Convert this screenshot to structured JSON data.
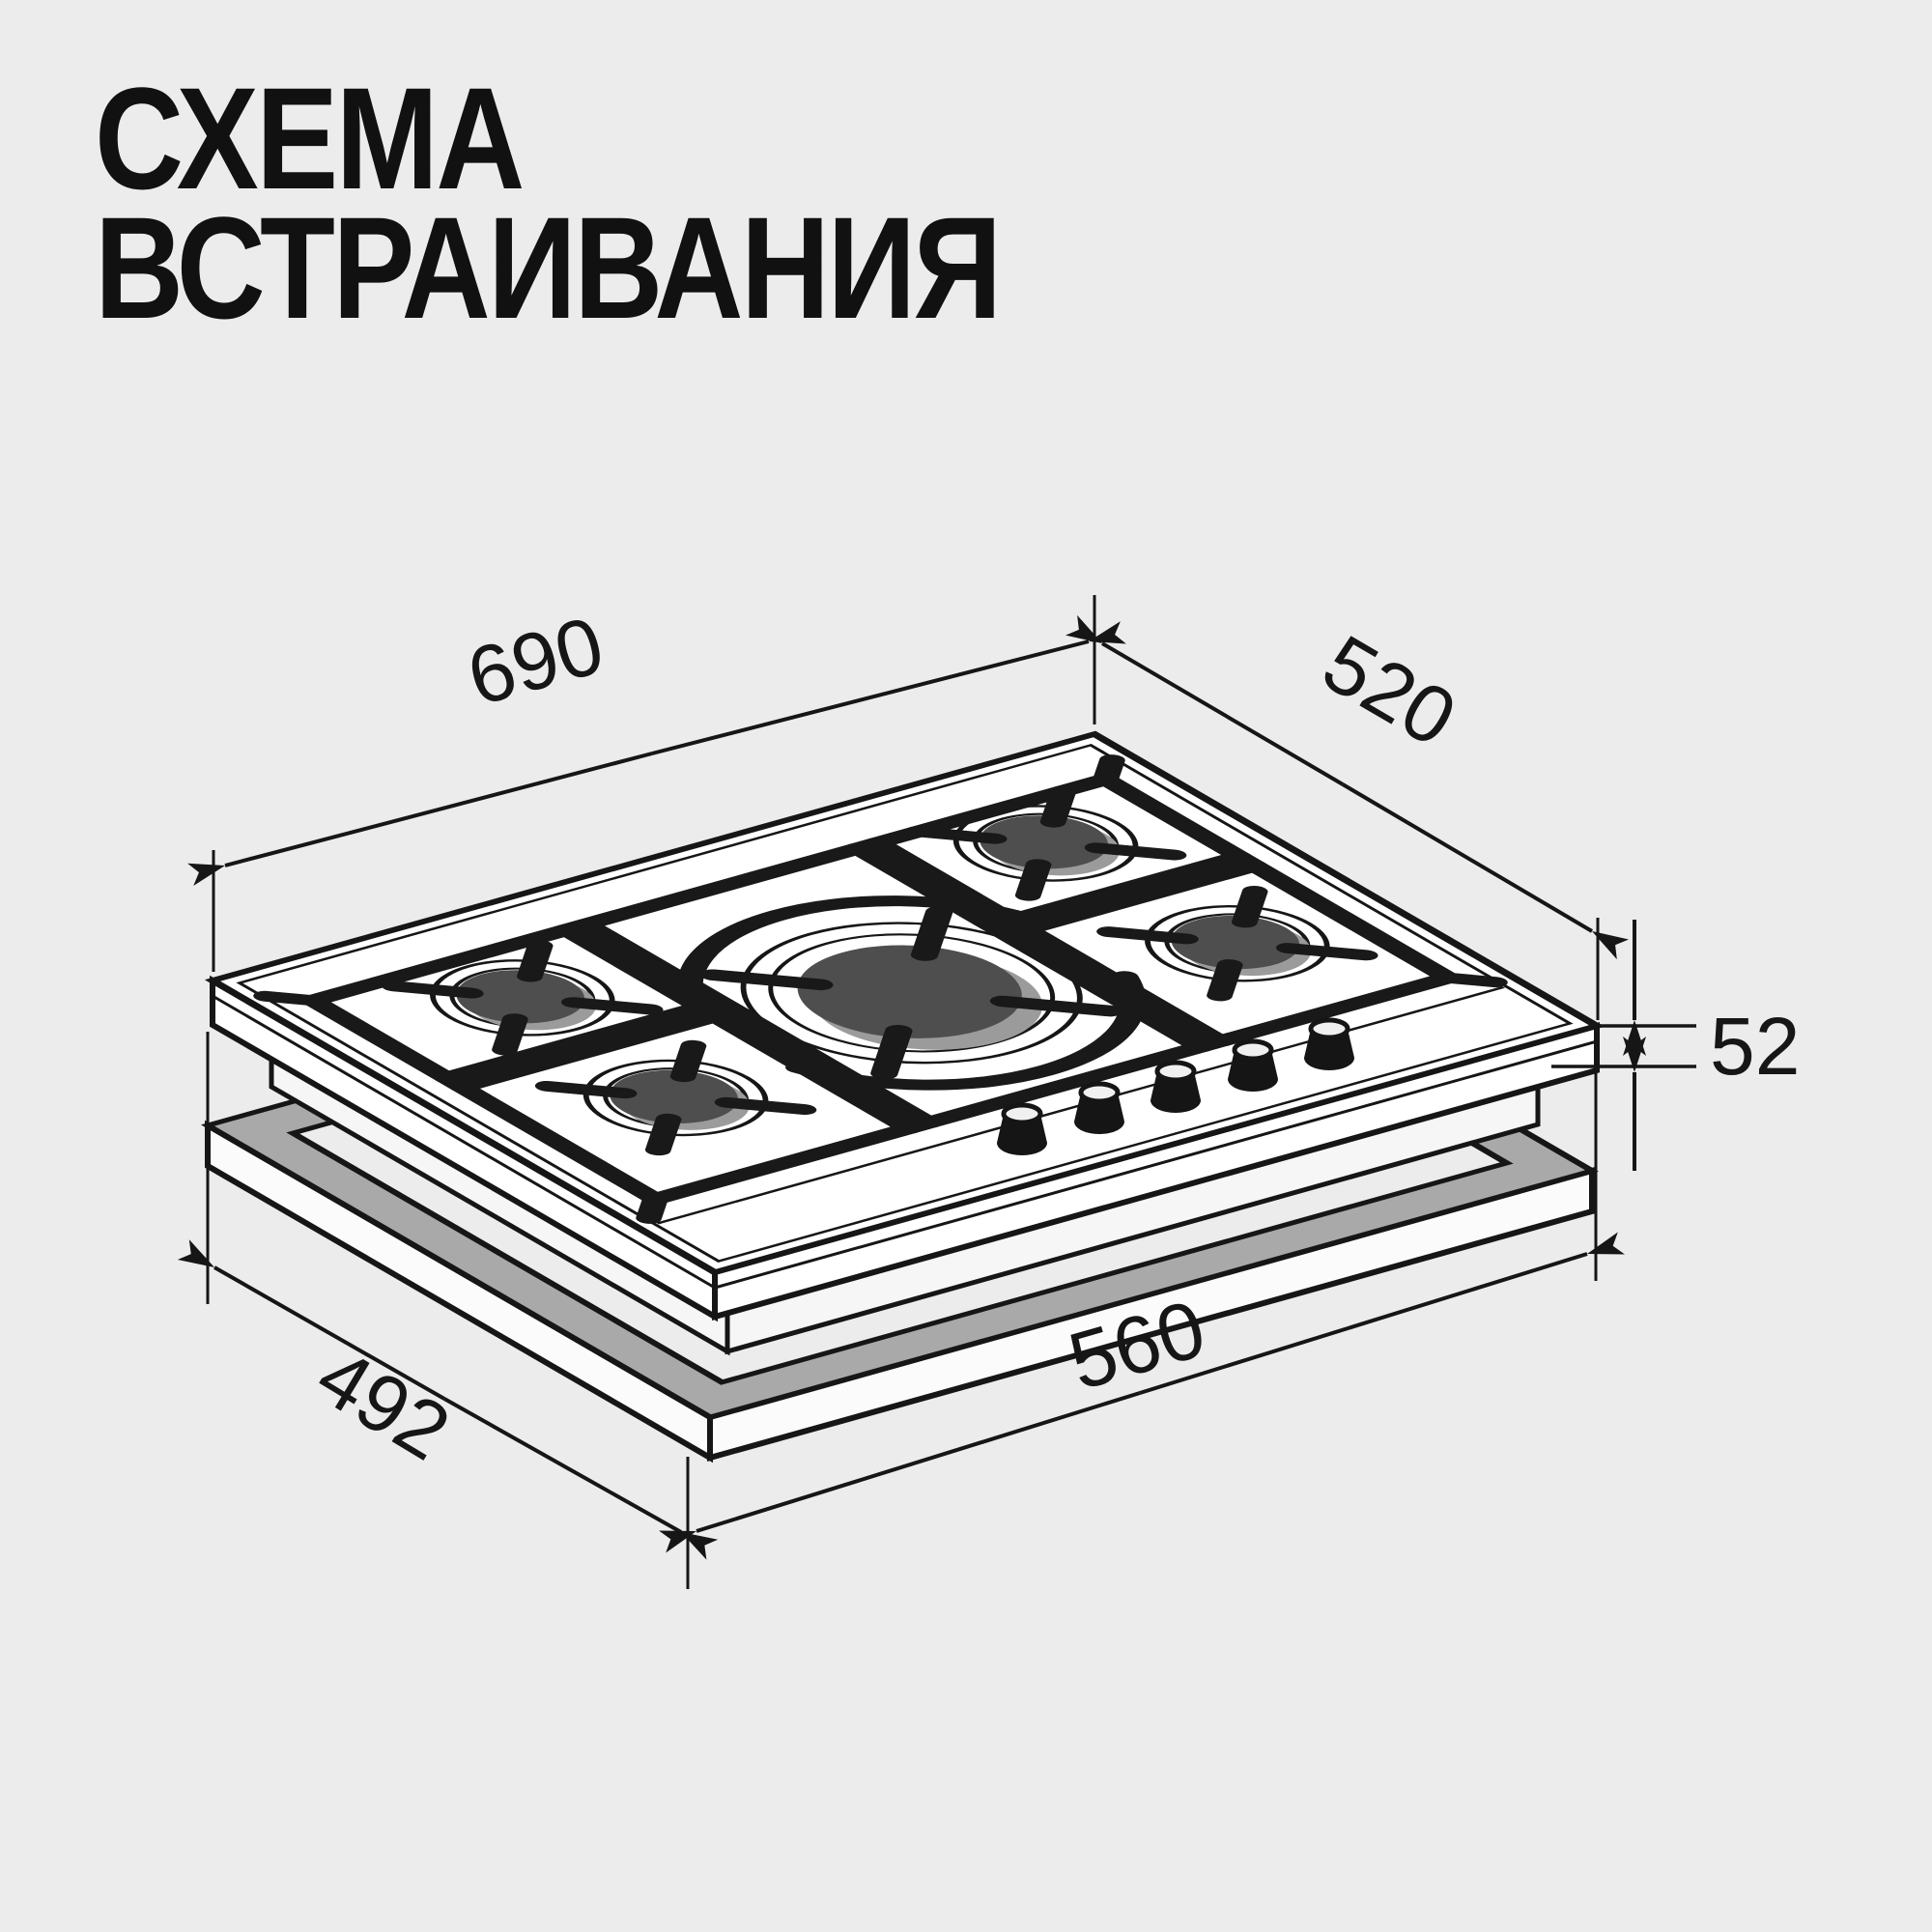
{
  "title": {
    "line1": "СХЕМА",
    "line2": "ВСТРАИВАНИЯ"
  },
  "diagram": {
    "type": "isometric installation drawing",
    "object": "5-burner gas hob above worktop cutout frame",
    "dimensions_mm": {
      "hob_width": "690",
      "hob_depth": "520",
      "hob_height": "52",
      "cutout_depth": "492",
      "cutout_width": "560"
    },
    "colors": {
      "background": "#ececec",
      "line": "#161616",
      "frame_gray": "#a9a9a9",
      "burner_cap_dark": "#4e4e4e",
      "burner_cap_light": "#9b9b9b",
      "plate_white": "#ffffff"
    }
  }
}
